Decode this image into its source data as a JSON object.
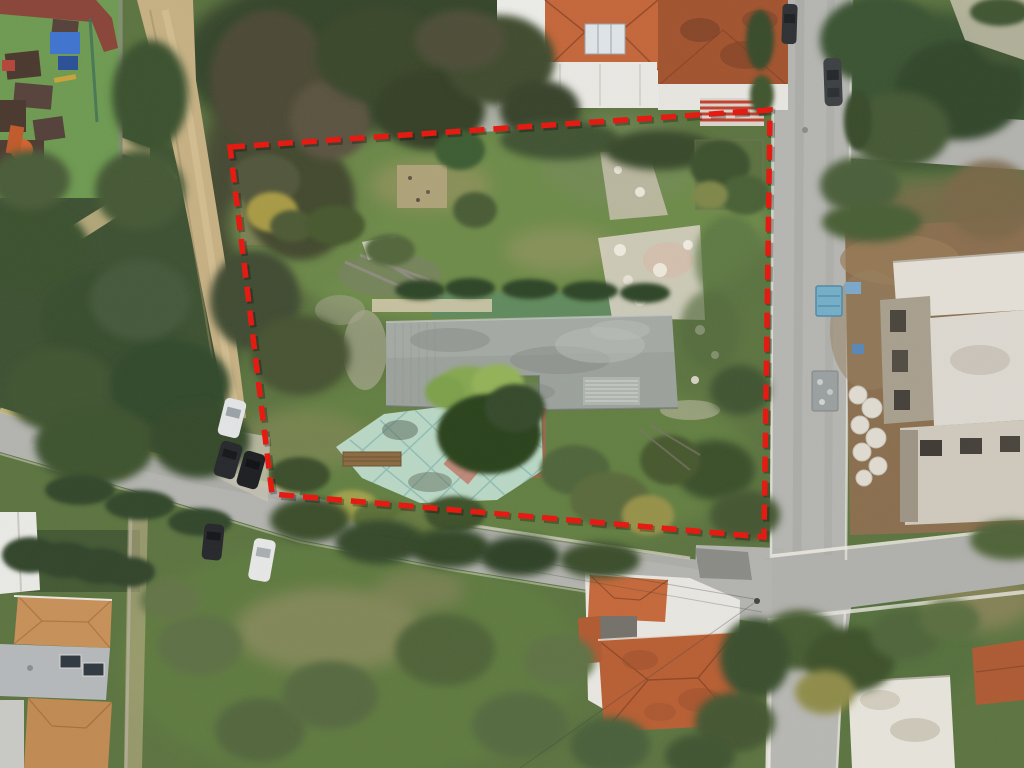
{
  "scene": {
    "title": "Aerial drone photo of a residential land plot marked with a red dashed boundary",
    "type": "aerial-photo",
    "width_px": 1024,
    "height_px": 768
  },
  "boundary": {
    "label": "plot-boundary",
    "color": "#e6170e",
    "points": "230,147 770,110 764,537 272,494",
    "dash_pattern": "15 9",
    "stroke_width": 5.5
  },
  "features": {
    "playground": "children's playground with blue canopy and orange slide (top left)",
    "park": "public green with trees and footpaths (left)",
    "dirt_road": "unpaved track (upper left)",
    "house_north": "white house with terracotta hip roof (top)",
    "street_east": "asphalt street running north-south (right)",
    "street_south": "asphalt street running diagonally (bottom left to junction)",
    "construction_site": "concrete building under construction (right)",
    "abandoned_slab": "unfinished concrete slab structure inside the plot",
    "tiled_courtyard": "mint-green tiled courtyard with diamond motif and trees inside the plot",
    "rubble_pile": "whitish construction debris inside the plot",
    "houses_southwest": "housing complex with tan tiled and flat roofs (bottom left)",
    "house_south": "house with terracotta roof (bottom center)",
    "cars": "parked cars along the streets",
    "blue_skip": "light-blue waste container on the east street"
  },
  "palette": {
    "vegetation_base": "#5c7440",
    "plot_grass": "#6f8e4c",
    "asphalt": "#b5b5b1",
    "dirt_track": "#c6b083",
    "concrete_slab": "#9ba19b",
    "courtyard_tiles": "#b9d7c5",
    "terracotta": "#b85e33",
    "boundary_red": "#e6170e"
  }
}
